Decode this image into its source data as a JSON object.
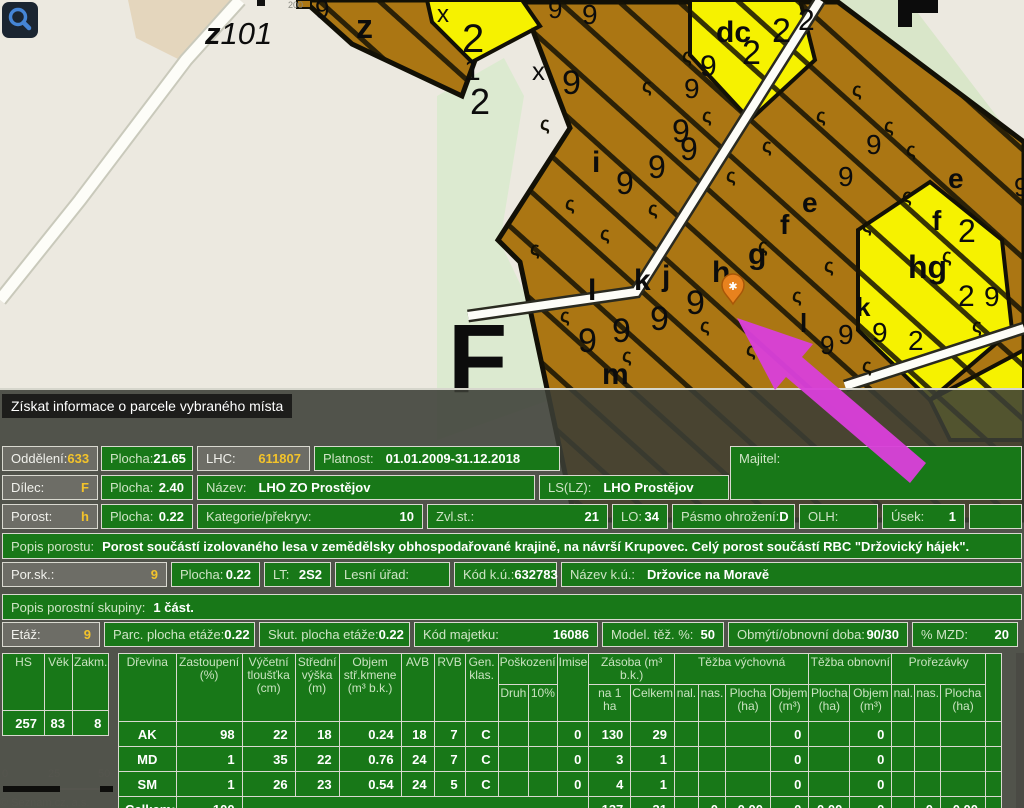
{
  "colors": {
    "panel_green": "#187818",
    "label_gray": "#6d6d66",
    "value_yellow": "#f3c32b",
    "parcel_brown": "#ab7613",
    "parcel_yellow": "#f6f200",
    "arrow_magenta": "#d940d9",
    "marker_orange": "#e8821e"
  },
  "map": {
    "tooltip": "Získat informace o parcele vybraného místa",
    "region_code_bold": "z",
    "region_code_rest": "101",
    "big_letter": "F",
    "tiny_label": "200",
    "marker_symbol": "✱",
    "squiggle_glyph": "ς",
    "labels": [
      {
        "t": "9",
        "x": 315,
        "y": 18,
        "s": 26
      },
      {
        "t": "z",
        "x": 356,
        "y": 38,
        "s": 34,
        "b": 1
      },
      {
        "t": "x",
        "x": 437,
        "y": 22,
        "s": 24
      },
      {
        "t": "2",
        "x": 462,
        "y": 52,
        "s": 40
      },
      {
        "t": "1",
        "x": 464,
        "y": 80,
        "s": 30
      },
      {
        "t": "2",
        "x": 470,
        "y": 114,
        "s": 36
      },
      {
        "t": "9",
        "x": 548,
        "y": 18,
        "s": 26
      },
      {
        "t": "9",
        "x": 582,
        "y": 24,
        "s": 28
      },
      {
        "t": "x",
        "x": 532,
        "y": 80,
        "s": 26
      },
      {
        "t": "9",
        "x": 562,
        "y": 94,
        "s": 34
      },
      {
        "t": "dc",
        "x": 716,
        "y": 42,
        "s": 30,
        "b": 1
      },
      {
        "t": "9",
        "x": 700,
        "y": 76,
        "s": 30
      },
      {
        "t": "2",
        "x": 742,
        "y": 64,
        "s": 34
      },
      {
        "t": "2",
        "x": 772,
        "y": 42,
        "s": 34
      },
      {
        "t": "2",
        "x": 798,
        "y": 30,
        "s": 30
      },
      {
        "t": "9",
        "x": 684,
        "y": 98,
        "s": 28
      },
      {
        "t": "9",
        "x": 672,
        "y": 142,
        "s": 32
      },
      {
        "t": "i",
        "x": 592,
        "y": 172,
        "s": 30,
        "b": 1
      },
      {
        "t": "9",
        "x": 616,
        "y": 194,
        "s": 32
      },
      {
        "t": "9",
        "x": 648,
        "y": 178,
        "s": 32
      },
      {
        "t": "9",
        "x": 680,
        "y": 160,
        "s": 32
      },
      {
        "t": "e",
        "x": 802,
        "y": 212,
        "s": 28,
        "b": 1
      },
      {
        "t": "9",
        "x": 838,
        "y": 186,
        "s": 28
      },
      {
        "t": "9",
        "x": 866,
        "y": 154,
        "s": 28
      },
      {
        "t": "f",
        "x": 780,
        "y": 234,
        "s": 28,
        "b": 1
      },
      {
        "t": "g",
        "x": 748,
        "y": 264,
        "s": 30,
        "b": 1
      },
      {
        "t": "h",
        "x": 712,
        "y": 282,
        "s": 30,
        "b": 1
      },
      {
        "t": "j",
        "x": 662,
        "y": 286,
        "s": 30,
        "b": 1
      },
      {
        "t": "k",
        "x": 634,
        "y": 290,
        "s": 30,
        "b": 1
      },
      {
        "t": "l",
        "x": 588,
        "y": 300,
        "s": 30,
        "b": 1
      },
      {
        "t": "9",
        "x": 578,
        "y": 352,
        "s": 34
      },
      {
        "t": "9",
        "x": 612,
        "y": 342,
        "s": 34
      },
      {
        "t": "9",
        "x": 650,
        "y": 330,
        "s": 34
      },
      {
        "t": "9",
        "x": 686,
        "y": 314,
        "s": 34
      },
      {
        "t": "m",
        "x": 602,
        "y": 384,
        "s": 30,
        "b": 1
      },
      {
        "t": "e",
        "x": 948,
        "y": 188,
        "s": 28,
        "b": 1
      },
      {
        "t": "f",
        "x": 932,
        "y": 230,
        "s": 28,
        "b": 1
      },
      {
        "t": "2",
        "x": 958,
        "y": 242,
        "s": 32
      },
      {
        "t": "hg",
        "x": 908,
        "y": 278,
        "s": 32,
        "b": 1
      },
      {
        "t": "k",
        "x": 856,
        "y": 316,
        "s": 26,
        "b": 1
      },
      {
        "t": "9",
        "x": 838,
        "y": 344,
        "s": 28
      },
      {
        "t": "9",
        "x": 872,
        "y": 342,
        "s": 28
      },
      {
        "t": "l",
        "x": 800,
        "y": 332,
        "s": 26,
        "b": 1
      },
      {
        "t": "9",
        "x": 820,
        "y": 354,
        "s": 26
      },
      {
        "t": "2",
        "x": 958,
        "y": 306,
        "s": 30
      },
      {
        "t": "9",
        "x": 984,
        "y": 306,
        "s": 28
      },
      {
        "t": "2",
        "x": 908,
        "y": 350,
        "s": 28
      },
      {
        "t": "9",
        "x": 1014,
        "y": 196,
        "s": 26
      }
    ],
    "scale": {
      "ticks": [
        "0",
        "25",
        "50"
      ],
      "copyright": "© Seznam.cz, a.s."
    }
  },
  "panel": {
    "r1": [
      {
        "label": "Oddělení:",
        "value": "633",
        "gray": 1
      },
      {
        "label": "Plocha:",
        "value": "21.65"
      },
      {
        "label": "LHC:",
        "value": "611807",
        "gray": 1
      },
      {
        "label": "Platnost:",
        "value": "01.01.2009-31.12.2018",
        "vleft": 1
      }
    ],
    "majitel": {
      "label": "Majitel:",
      "value": ""
    },
    "r2": [
      {
        "label": "Dílec:",
        "value": "F",
        "gray": 1
      },
      {
        "label": "Plocha:",
        "value": "2.40"
      },
      {
        "label": "Název:",
        "value": "LHO ZO Prostějov",
        "vleft": 1
      },
      {
        "label": "LS(LZ):",
        "value": "LHO Prostějov",
        "vleft": 1
      }
    ],
    "r3": [
      {
        "label": "Porost:",
        "value": "h",
        "gray": 1
      },
      {
        "label": "Plocha:",
        "value": "0.22"
      },
      {
        "label": "Kategorie/překryv:",
        "value": "10"
      },
      {
        "label": "Zvl.st.:",
        "value": "21"
      },
      {
        "label": "LO:",
        "value": "34"
      },
      {
        "label": "Pásmo ohrožení:",
        "value": "D"
      },
      {
        "label": "OLH:",
        "value": ""
      },
      {
        "label": "Úsek:",
        "value": "1"
      },
      {
        "label": "",
        "value": ""
      }
    ],
    "r4": {
      "label": "Popis porostu:",
      "value": "Porost součástí izolovaného lesa v zemědělsky obhospodařované krajině, na návrší Krupovec. Celý porost součástí RBC \"Držovický hájek\"."
    },
    "r5": [
      {
        "label": "Por.sk.:",
        "value": "9",
        "gray": 1
      },
      {
        "label": "Plocha:",
        "value": "0.22"
      },
      {
        "label": "LT:",
        "value": "2S2"
      },
      {
        "label": "Lesní úřad:",
        "value": ""
      },
      {
        "label": "Kód k.ú.:",
        "value": "632783"
      },
      {
        "label": "Název k.ú.:",
        "value": "Držovice na Moravě",
        "vleft": 1
      }
    ],
    "r6": {
      "label": "Popis porostní skupiny:",
      "value": "1 část."
    },
    "r7": [
      {
        "label": "Etáž:",
        "value": "9",
        "gray": 1
      },
      {
        "label": "Parc. plocha etáže:",
        "value": "0.22"
      },
      {
        "label": "Skut. plocha etáže:",
        "value": "0.22"
      },
      {
        "label": "Kód majetku:",
        "value": "16086"
      },
      {
        "label": "Model. těž. %:",
        "value": "50"
      },
      {
        "label": "Obmýtí/obnovní doba:",
        "value": "90/30"
      },
      {
        "label": "% MZD:",
        "value": "20"
      }
    ]
  },
  "table": {
    "left": {
      "headers": [
        "HS",
        "Věk",
        "Zakm."
      ],
      "row": [
        "257",
        "83",
        "8"
      ]
    },
    "columns": [
      {
        "lines": [
          "Dřevina"
        ]
      },
      {
        "lines": [
          "Zastoupení",
          "(%)"
        ]
      },
      {
        "lines": [
          "Výčetní",
          "tloušťka",
          "(cm)"
        ]
      },
      {
        "lines": [
          "Střední",
          "výška",
          "(m)"
        ]
      },
      {
        "lines": [
          "Objem",
          "stř.kmene",
          "(m³ b.k.)"
        ]
      },
      {
        "lines": [
          "AVB"
        ]
      },
      {
        "lines": [
          "RVB"
        ]
      },
      {
        "lines": [
          "Gen.",
          "klas."
        ]
      },
      {
        "group": "Poškození",
        "lines": [
          "Druh"
        ]
      },
      {
        "group": "Poškození",
        "lines": [
          "10%"
        ]
      },
      {
        "lines": [
          "Imise"
        ]
      },
      {
        "group": "Zásoba (m³ b.k.)",
        "lines": [
          "na 1 ha"
        ]
      },
      {
        "group": "Zásoba (m³ b.k.)",
        "lines": [
          "Celkem"
        ]
      },
      {
        "group": "Těžba výchovná",
        "lines": [
          "nal."
        ]
      },
      {
        "group": "Těžba výchovná",
        "lines": [
          "nas."
        ]
      },
      {
        "group": "Těžba výchovná",
        "lines": [
          "Plocha",
          "(ha)"
        ]
      },
      {
        "group": "Těžba výchovná",
        "lines": [
          "Objem",
          "(m³)"
        ]
      },
      {
        "group": "Těžba obnovní",
        "lines": [
          "Plocha",
          "(ha)"
        ]
      },
      {
        "group": "Těžba obnovní",
        "lines": [
          "Objem",
          "(m³)"
        ]
      },
      {
        "group": "Prořezávky",
        "lines": [
          "nal."
        ]
      },
      {
        "group": "Prořezávky",
        "lines": [
          "nas."
        ]
      },
      {
        "group": "Prořezávky",
        "lines": [
          "Plocha",
          "(ha)"
        ]
      },
      {
        "lines": [
          ""
        ]
      }
    ],
    "rows": [
      [
        "AK",
        "98",
        "22",
        "18",
        "0.24",
        "18",
        "7",
        "C",
        "",
        "",
        "0",
        "130",
        "29",
        "",
        "",
        "",
        "0",
        "",
        "0",
        "",
        "",
        "",
        ""
      ],
      [
        "MD",
        "1",
        "35",
        "22",
        "0.76",
        "24",
        "7",
        "C",
        "",
        "",
        "0",
        "3",
        "1",
        "",
        "",
        "",
        "0",
        "",
        "0",
        "",
        "",
        "",
        ""
      ],
      [
        "SM",
        "1",
        "26",
        "23",
        "0.54",
        "24",
        "5",
        "C",
        "",
        "",
        "0",
        "4",
        "1",
        "",
        "",
        "",
        "0",
        "",
        "0",
        "",
        "",
        "",
        ""
      ]
    ],
    "total_row": {
      "label": "Celkem:",
      "zastoupeni": "100",
      "cells": [
        "137",
        "31",
        "",
        "0",
        "0.00",
        "0",
        "0.00",
        "0",
        "",
        "0",
        "0.00",
        ""
      ]
    }
  }
}
